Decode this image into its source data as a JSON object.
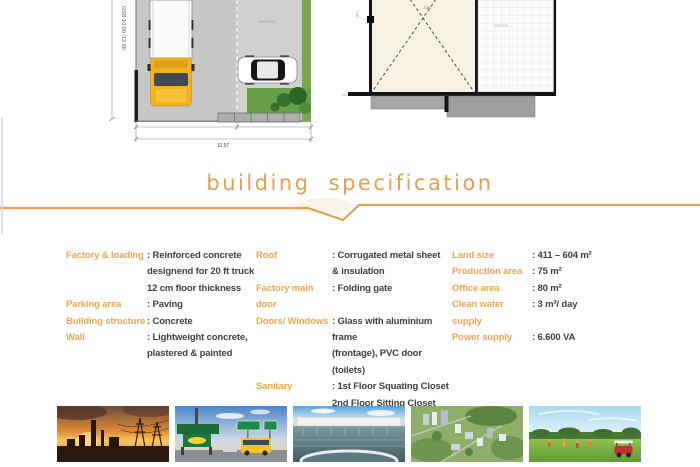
{
  "colors": {
    "accent": "#E2A051",
    "spec_label": "#F1A64E",
    "spec_value": "#3F3F3F"
  },
  "plans": {
    "site_plan": {
      "gsb_label": "GSB 10.00 /12.00",
      "parking_label": "PARKING",
      "dimension_label": "10.97"
    },
    "floor_plan": {
      "room_dimension_label": "7.20",
      "side_dimension_label": "7.00",
      "area_label": "OFFICE"
    }
  },
  "spec": {
    "heading": "building specification",
    "columns": [
      {
        "entries": [
          {
            "label": "Factory & loading",
            "value_lines": [
              ": Reinforced concrete",
              "designend for 20 ft truck",
              "12 cm floor thickness"
            ]
          },
          {
            "label": "Parking area",
            "value_lines": [
              ": Paving"
            ]
          },
          {
            "label": "Building structure",
            "value_lines": [
              ": Concrete"
            ]
          },
          {
            "label": "Wall",
            "value_lines": [
              ": Lightweight concrete,",
              "plastered & painted"
            ]
          }
        ]
      },
      {
        "entries": [
          {
            "label": "Roof",
            "value_lines": [
              ": Corrugated metal sheet",
              "& insulation"
            ]
          },
          {
            "label": "Factory main door",
            "value_lines": [
              ": Folding gate"
            ]
          },
          {
            "label": "Doors/ Windows",
            "value_lines": [
              ": Glass with aluminium frame",
              "(frontage), PVC door (toilets)"
            ]
          },
          {
            "label": "Sanitary",
            "value_lines": [
              ": 1st Floor Squating Closet",
              "2nd Floor Sitting Closet"
            ]
          }
        ]
      },
      {
        "entries": [
          {
            "label": "Land size",
            "value_lines": [
              ": 411 – 604 m²"
            ]
          },
          {
            "label": "Production area",
            "value_lines": [
              ": 75 m²"
            ]
          },
          {
            "label": "Office area",
            "value_lines": [
              ": 80 m²"
            ]
          },
          {
            "label": "Clean water supply",
            "value_lines": [
              ": 3 m³/ day"
            ]
          },
          {
            "label": "Power supply",
            "value_lines": [
              ": 6.600 VA"
            ]
          }
        ]
      }
    ]
  },
  "photos": {
    "items": [
      {
        "name": "industrial-plant-sunset"
      },
      {
        "name": "toll-gate"
      },
      {
        "name": "water-treatment-plant"
      },
      {
        "name": "city-aerial-view"
      },
      {
        "name": "golf-course"
      }
    ]
  }
}
